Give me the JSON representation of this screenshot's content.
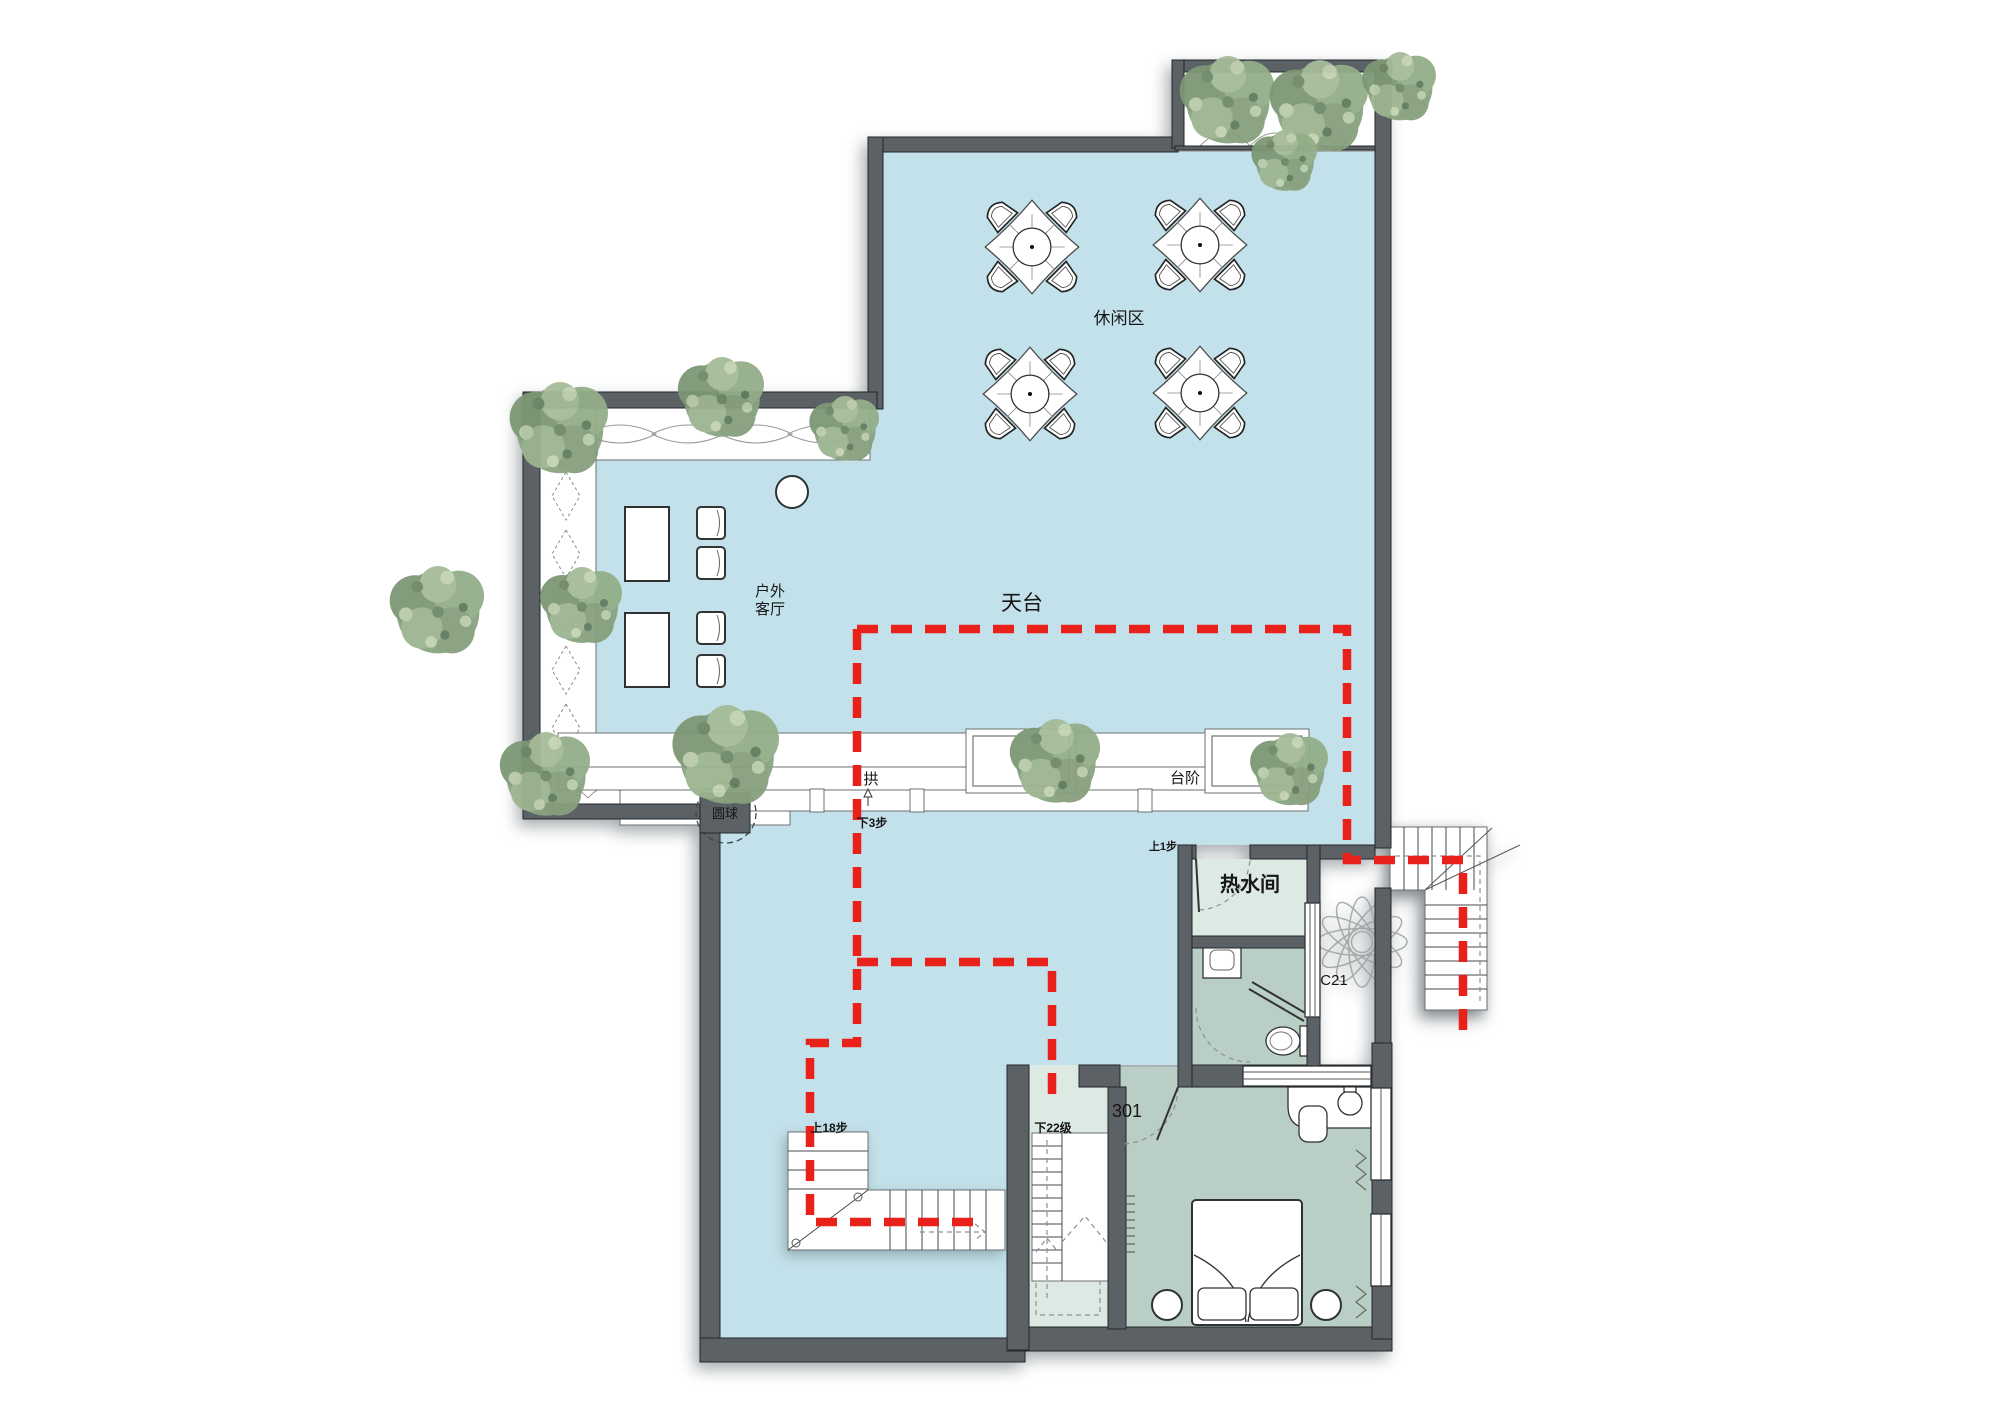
{
  "colors": {
    "terrace_blue": "#c3e1ea",
    "room_pale": "#dde9e3",
    "room_sage": "#b9cfc5",
    "wall": "#5c6165",
    "route_red": "#e8211b",
    "tree_green": "#8aa482"
  },
  "rooms": {
    "leisure": {
      "label": "休闲区"
    },
    "outdoor_living": {
      "line1": "户外",
      "line2": "客厅"
    },
    "terrace": {
      "label": "天台"
    },
    "hot_water": {
      "label": "热水间"
    },
    "bedroom": {
      "number": "301"
    },
    "arch": {
      "label": "拱"
    },
    "steps": {
      "label": "台阶"
    },
    "sphere": {
      "label": "圆球"
    }
  },
  "annotations": {
    "down_3_steps": "下3步",
    "up_1_step": "上1步",
    "up_18_steps": "上18步",
    "down_22_steps": "下22级",
    "window_code": "C21"
  },
  "icons": {
    "tree": "tree-icon",
    "patio_table": "patio-table-icon",
    "bed": "bed-icon",
    "toilet": "toilet-icon",
    "sink": "sink-icon",
    "stairs": "stairs-icon",
    "fan_plant": "fan-plant-icon",
    "route": "route-dashed-line"
  }
}
